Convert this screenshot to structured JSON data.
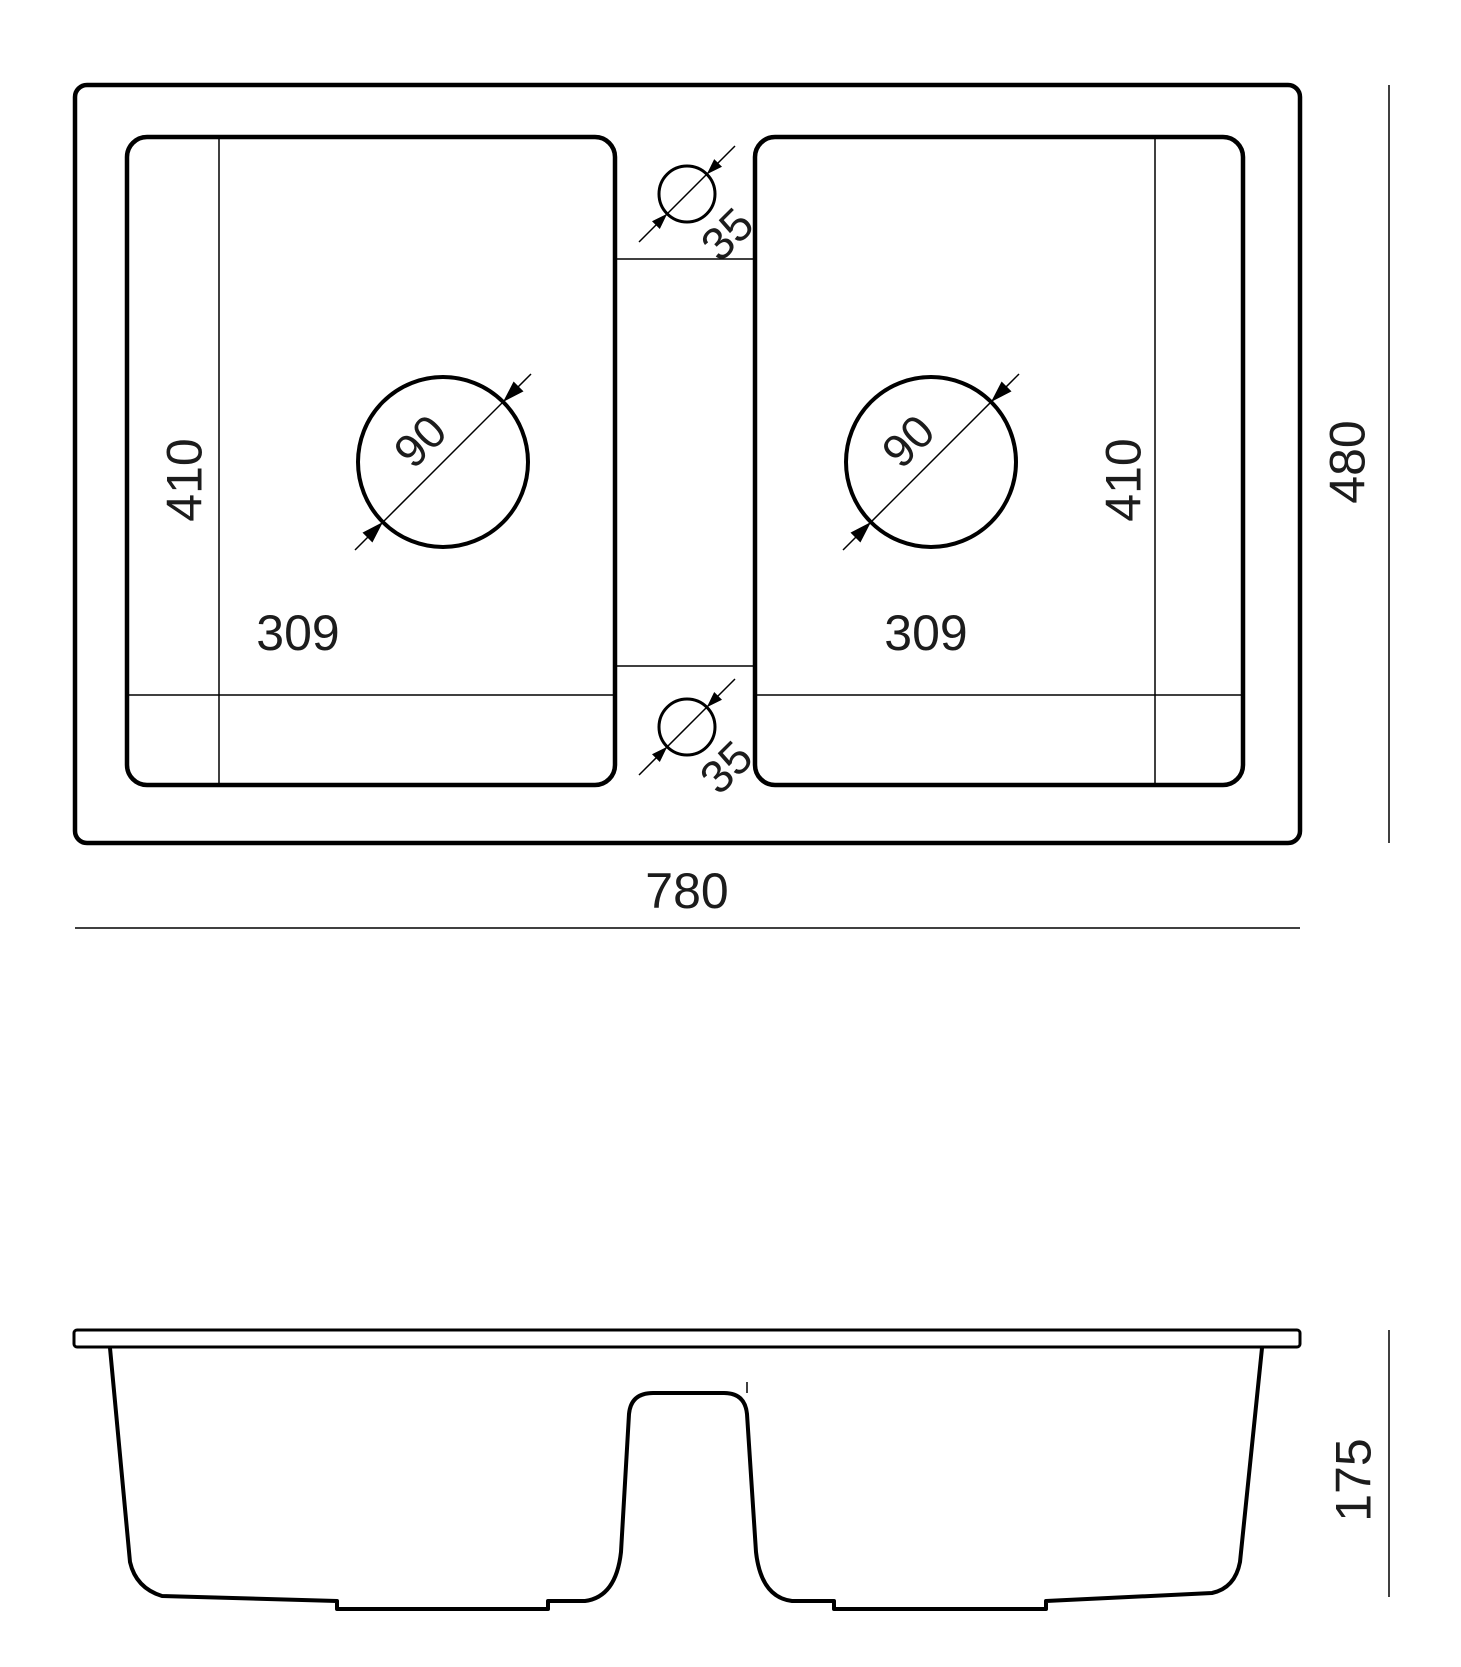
{
  "colors": {
    "line": "#000000",
    "text": "#1c1c1c",
    "background": "#ffffff"
  },
  "drawing": {
    "type": "technical-drawing",
    "subject": "double-bowl-kitchen-sink",
    "top_view": {
      "overall_width": "780",
      "overall_depth": "480",
      "left_bowl": {
        "depth": "410",
        "width": "309",
        "drain_diameter": "90"
      },
      "right_bowl": {
        "depth": "410",
        "width": "309",
        "drain_diameter": "90"
      },
      "tap_hole_top": "35",
      "tap_hole_bottom": "35"
    },
    "front_view": {
      "height": "175"
    }
  }
}
